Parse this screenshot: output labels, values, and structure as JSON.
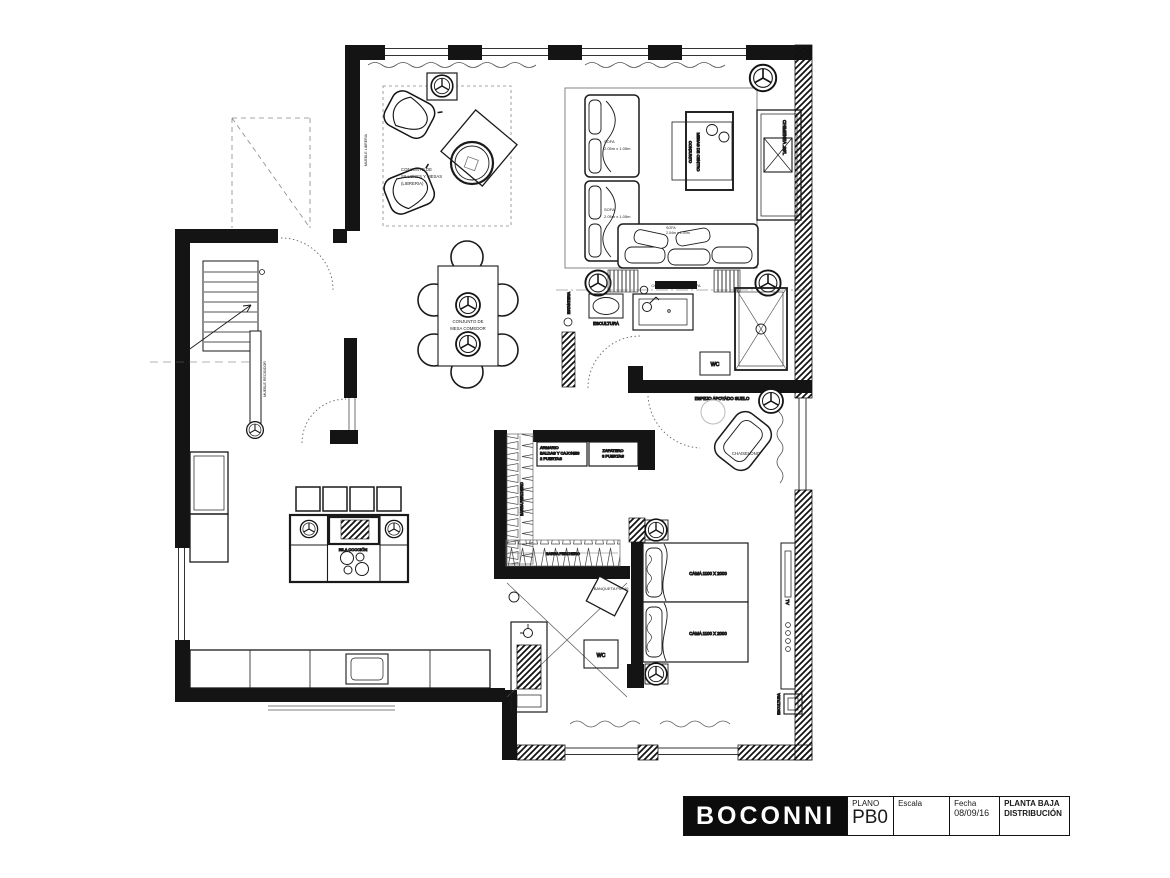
{
  "title_block": {
    "brand": "BOCONNI",
    "plano_label": "PLANO",
    "plano_value": "PB0",
    "escala_label": "Escala",
    "fecha_label": "Fecha",
    "fecha_value": "08/09/16",
    "sheet_line1": "PLANTA BAJA",
    "sheet_line2": "DISTRIBUCIÓN"
  },
  "labels": {
    "mueble_libreria": "MUEBLE LIBRERIA",
    "conjunto_sillones": [
      "CONJUNTO DE",
      "SILLONES Y MESAS",
      "(LIBRERIA)"
    ],
    "mesa_comedor": [
      "CONJUNTO DE",
      "MESA COMEDOR"
    ],
    "mesas_centro": [
      "CONJUNTO",
      "MESAS DE CENTRO"
    ],
    "sofa_vertical": [
      "SOFA",
      "2.05m x 1.05m"
    ],
    "sofa_horizontal": [
      "SOFA",
      "2.04m x 1.00m"
    ],
    "chimenea": "CHIMENEA .99'L",
    "cortina_trasera": "CORTINA TRASERA SOFA",
    "escultura": "ESCULTURA",
    "estanteria": "ESTANTERIA",
    "wc": "WC",
    "espejo": "ESPEJO APOYADO SUELO",
    "chaiselong": "CHAISELONG",
    "mueble_recibidor": "MUEBLE RECIBIDOR",
    "armario": [
      "ARMARIO",
      "BALDAS Y CAJONES",
      "2 PUERTAS"
    ],
    "zapatero": [
      "ZAPATERO",
      "3 PUERTAS"
    ],
    "barra_perchero": "BARRA PERCHERO",
    "isla_coccion": "ISLA COCCIÓN",
    "banqueta": "BANQUETA PIE 40",
    "cama": "CAMA 1100 X 2000",
    "tv": "TV"
  }
}
